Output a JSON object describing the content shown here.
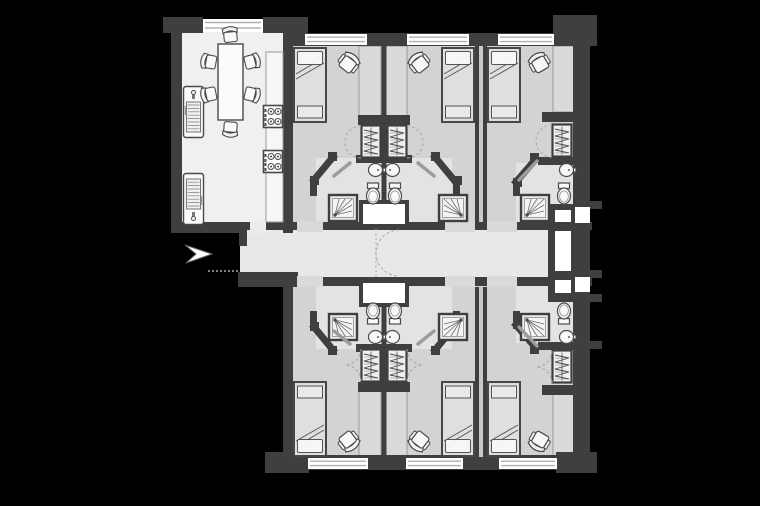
{
  "meta": {
    "title": "Residential floor plan",
    "type": "architectural floor plan",
    "description": "Floor plan of a shared flat: six en-suite single bedrooms arranged around a central corridor with a shared kitchen-dining room at the top left and an entrance arrow at the left.",
    "visible_text": []
  },
  "colors": {
    "background": "#000000",
    "wall": "#3f3f3f",
    "room_floor": "#d3d3d5",
    "kitchen_floor": "#f0f0f0",
    "corridor_floor": "#e8e8e8",
    "bathroom_floor": "#e3e3e4",
    "desk_fill": "#dadadc",
    "fixture_fill": "#f8f8f8",
    "fixture_stroke": "#4a4a4c",
    "window_line": "#b0b0b0",
    "door_leaf": "#9c9c9c",
    "swing_dash": "#a8a8a8",
    "shaft_fill": "#ffffff"
  },
  "plan": {
    "entrance": {
      "indicator": "white arrow pointing right into corridor",
      "position": "left side, below kitchen"
    },
    "corridor": {
      "orientation": "horizontal",
      "features": [
        "entrance opening",
        "dashed double swing door mid-way",
        "service shafts at right end"
      ]
    },
    "kitchen_dining_room": {
      "position": "top left",
      "furniture": [
        "dining table",
        "6 dining chairs",
        "worktop along right wall",
        "2 four-ring hobs",
        "2 sink-drainer units on left wall"
      ],
      "windows": 1
    },
    "bedrooms": [
      {
        "id": "bedroom-top-1",
        "position": "top row, left",
        "furniture": [
          "single bed",
          "desk",
          "desk chair",
          "wardrobe"
        ],
        "ensuite": [
          "shower",
          "toilet",
          "wash basin"
        ],
        "windows": 1
      },
      {
        "id": "bedroom-top-2",
        "position": "top row, middle",
        "furniture": [
          "single bed",
          "desk",
          "desk chair",
          "wardrobe"
        ],
        "ensuite": [
          "shower",
          "toilet",
          "wash basin"
        ],
        "windows": 1
      },
      {
        "id": "bedroom-top-3",
        "position": "top row, right",
        "furniture": [
          "single bed",
          "desk",
          "desk chair",
          "wardrobe"
        ],
        "ensuite": [
          "shower",
          "toilet",
          "wash basin"
        ],
        "windows": 1
      },
      {
        "id": "bedroom-bottom-1",
        "position": "bottom row, left",
        "furniture": [
          "single bed",
          "desk",
          "desk chair",
          "wardrobe"
        ],
        "ensuite": [
          "shower",
          "toilet",
          "wash basin"
        ],
        "windows": 1
      },
      {
        "id": "bedroom-bottom-2",
        "position": "bottom row, middle",
        "furniture": [
          "single bed",
          "desk",
          "desk chair",
          "wardrobe"
        ],
        "ensuite": [
          "shower",
          "toilet",
          "wash basin"
        ],
        "windows": 1
      },
      {
        "id": "bedroom-bottom-3",
        "position": "bottom row, right",
        "furniture": [
          "single bed",
          "desk",
          "desk chair",
          "wardrobe"
        ],
        "ensuite": [
          "shower",
          "toilet",
          "wash basin"
        ],
        "windows": 1
      }
    ],
    "counts": {
      "bedrooms": 6,
      "bathrooms": 6,
      "windows": 7,
      "wardrobes": 6,
      "showers": 6,
      "toilets": 6,
      "wash_basins": 6
    }
  }
}
